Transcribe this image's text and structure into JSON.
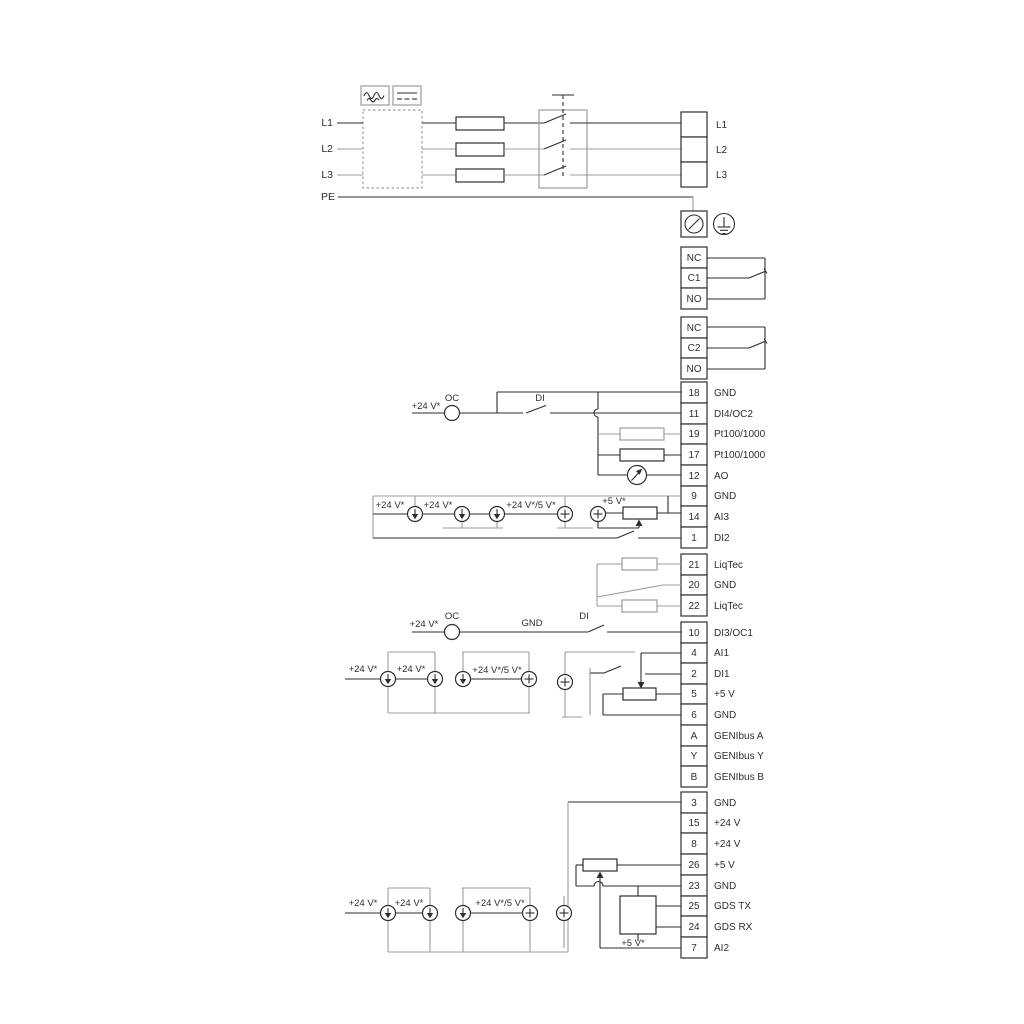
{
  "colors": {
    "ink": "#2e2e2e",
    "gray": "#9d9d9d",
    "paper": "#ffffff"
  },
  "power_in": {
    "l1": "L1",
    "l2": "L2",
    "l3": "L3",
    "pe": "PE"
  },
  "power_out": {
    "l1": "L1",
    "l2": "L2",
    "l3": "L3"
  },
  "relay1": {
    "nc": "NC",
    "c": "C1",
    "no": "NO"
  },
  "relay2": {
    "nc": "NC",
    "c": "C2",
    "no": "NO"
  },
  "groups": {
    "g1": [
      {
        "n": "18",
        "l": "GND"
      },
      {
        "n": "11",
        "l": "DI4/OC2"
      },
      {
        "n": "19",
        "l": "Pt100/1000"
      },
      {
        "n": "17",
        "l": "Pt100/1000"
      },
      {
        "n": "12",
        "l": "AO"
      },
      {
        "n": "9",
        "l": "GND"
      },
      {
        "n": "14",
        "l": "AI3"
      },
      {
        "n": "1",
        "l": "DI2"
      }
    ],
    "liqtec": [
      {
        "n": "21",
        "l": "LiqTec"
      },
      {
        "n": "20",
        "l": "GND"
      },
      {
        "n": "22",
        "l": "LiqTec"
      }
    ],
    "g3": [
      {
        "n": "10",
        "l": "DI3/OC1"
      },
      {
        "n": "4",
        "l": "AI1"
      },
      {
        "n": "2",
        "l": "DI1"
      },
      {
        "n": "5",
        "l": "+5 V"
      },
      {
        "n": "6",
        "l": "GND"
      },
      {
        "n": "A",
        "l": "GENIbus A"
      },
      {
        "n": "Y",
        "l": "GENIbus Y"
      },
      {
        "n": "B",
        "l": "GENIbus B"
      }
    ],
    "g4": [
      {
        "n": "3",
        "l": "GND"
      },
      {
        "n": "15",
        "l": "+24 V"
      },
      {
        "n": "8",
        "l": "+24 V"
      },
      {
        "n": "26",
        "l": "+5 V"
      },
      {
        "n": "23",
        "l": "GND"
      },
      {
        "n": "25",
        "l": "GDS TX"
      },
      {
        "n": "24",
        "l": "GDS RX"
      },
      {
        "n": "7",
        "l": "AI2"
      }
    ]
  },
  "ann": {
    "v24": "+24 V*",
    "v24or5": "+24 V*/5 V*",
    "v5": "+5 V*",
    "oc": "OC",
    "di": "DI",
    "gnd": "GND"
  }
}
